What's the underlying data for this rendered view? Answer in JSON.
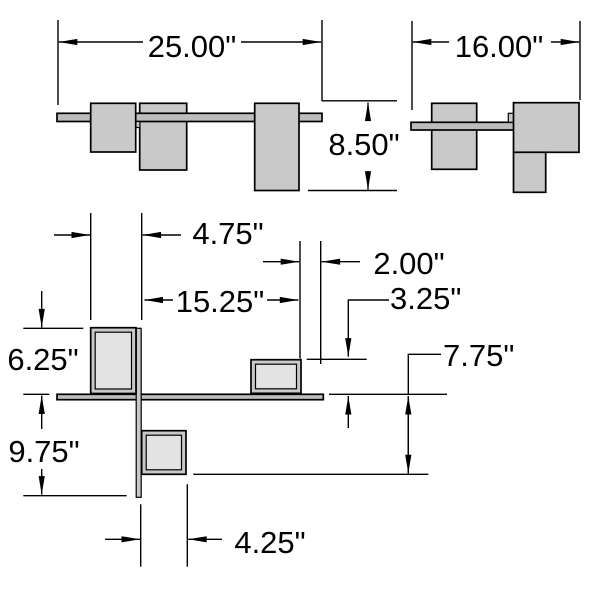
{
  "drawing": {
    "type": "dimensioned-technical-drawing",
    "unit_suffix": "\"",
    "colors": {
      "background": "#ffffff",
      "line": "#000000",
      "box_fill": "#c9c9c9",
      "box_inner_fill": "#e3e3e3",
      "bar_fill": "#bdbdbd"
    },
    "icons": {
      "dimension_arrow": "filled-triangle-arrowhead"
    },
    "dimensions": {
      "front_width": "25.00\"",
      "front_height": "8.50\"",
      "side_width": "16.00\"",
      "plan_left_inset": "4.75\"",
      "plan_right_inset": "2.00\"",
      "plan_center_span": "15.25\"",
      "plan_right_depth": "3.25\"",
      "plan_left_depth": "6.25\"",
      "plan_lower_depth": "7.75\"",
      "plan_stem_depth": "9.75\"",
      "plan_lower_width": "4.25\""
    }
  }
}
